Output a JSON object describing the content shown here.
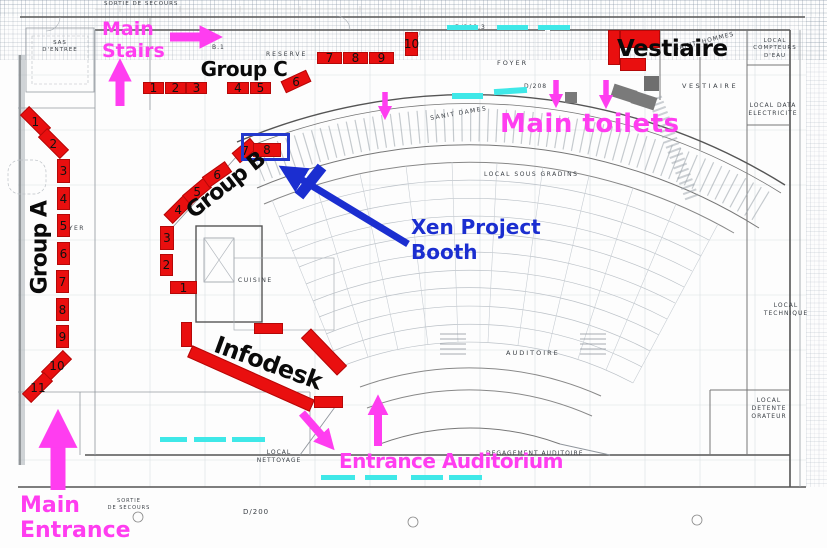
{
  "annotations": {
    "main_stairs": "Main\nStairs",
    "main_toilets": "Main toilets",
    "main_entrance": "Main\nEntrance",
    "entrance_auditorium": "Entrance Auditorium",
    "xen_booth": "Xen Project\nBooth",
    "infodesk": "Infodesk",
    "vestiaire": "Vestiaire"
  },
  "groups": {
    "a": {
      "label": "Group A",
      "booths": [
        "1",
        "2",
        "3",
        "4",
        "5",
        "6",
        "7",
        "8",
        "9",
        "10",
        "11"
      ]
    },
    "b": {
      "label": "Group B",
      "booths": [
        "1",
        "2",
        "3",
        "4",
        "5",
        "6",
        "7",
        "8"
      ]
    },
    "c": {
      "label": "Group C",
      "booths": [
        "1",
        "2",
        "3",
        "4",
        "5",
        "6",
        "7",
        "8",
        "9",
        "10"
      ]
    }
  },
  "plan_labels": [
    "SORTIE DE SECOURS",
    "SAS\nD'ENTREE",
    "RESERVE",
    "B.1",
    "FOYER",
    "D/208.3",
    "D/208",
    "SANIT DAMES",
    "SANIT. HOMMES",
    "VESTIAIRE",
    "LOCAL\nCOMPTEURS\nD'EAU",
    "LOCAL DATA\nELECTRICITE",
    "LOCAL SOUS GRADINS",
    "AUDITOIRE",
    "LOCAL\nTECHNIQUE",
    "LOCAL\nDETENTE\nORATEUR",
    "LOCAL\nNETTOYAGE",
    "DEGAGEMENT AUDITOIRE",
    "CUISINE",
    "SORTIE\nDE SECOURS",
    "D/200",
    "FOYER"
  ],
  "colors": {
    "booth_red": "#e90f0f",
    "annotation_magenta": "#ff3df0",
    "annotation_blue": "#1b2ed0",
    "highlight_cyan": "#3fe8e8",
    "plan_line_gray": "#8a9097"
  }
}
